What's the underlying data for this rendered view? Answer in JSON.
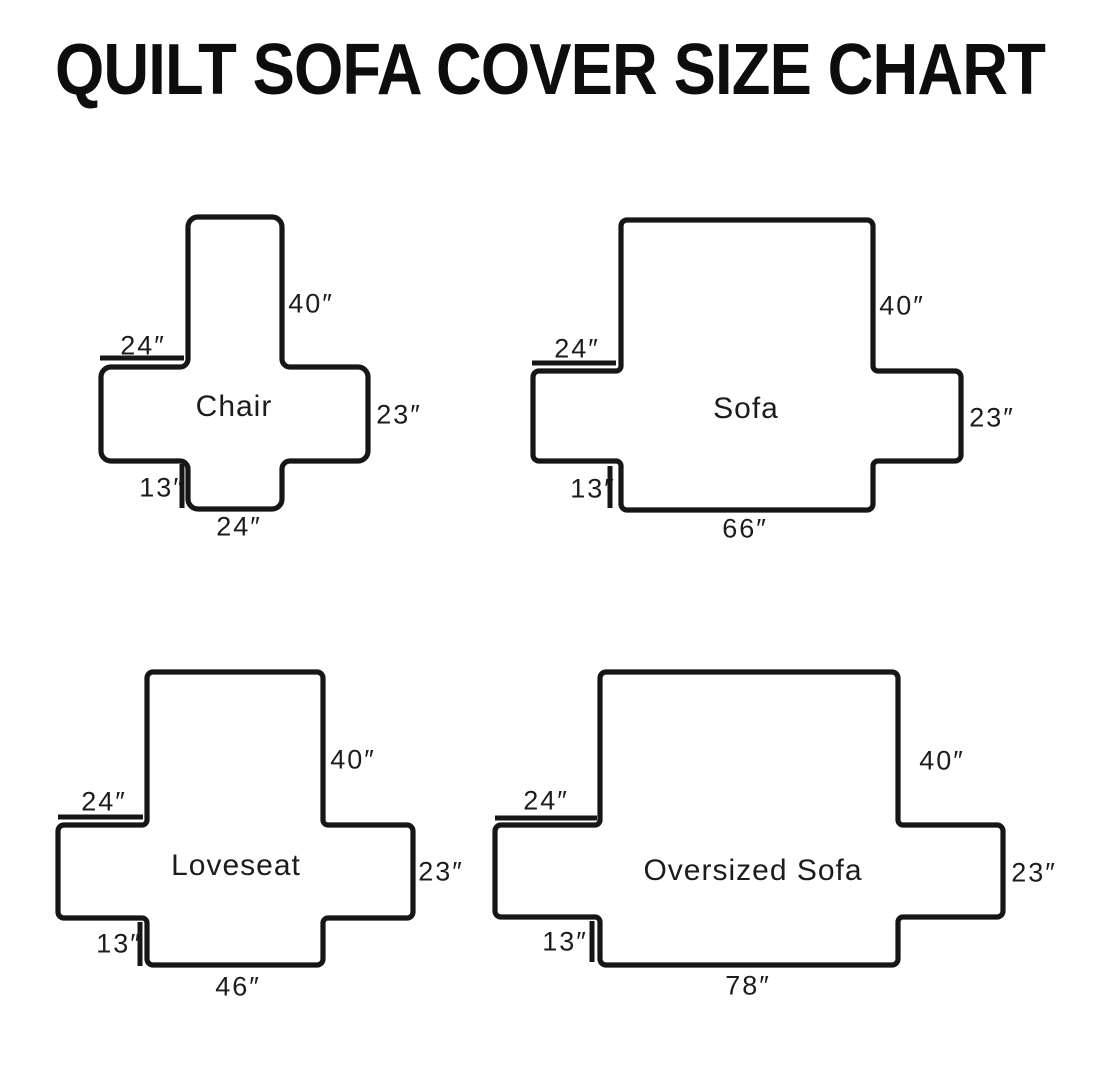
{
  "title": "QUILT SOFA COVER SIZE CHART",
  "colors": {
    "background": "#ffffff",
    "line": "#161616",
    "text": "#1c1c1c"
  },
  "diagrams": [
    {
      "name": "Chair",
      "back_height": "40″",
      "arm_top_width": "24″",
      "side_height": "23″",
      "skirt_drop": "13″",
      "base_width": "24″"
    },
    {
      "name": "Sofa",
      "back_height": "40″",
      "arm_top_width": "24″",
      "side_height": "23″",
      "skirt_drop": "13″",
      "base_width": "66″"
    },
    {
      "name": "Loveseat",
      "back_height": "40″",
      "arm_top_width": "24″",
      "side_height": "23″",
      "skirt_drop": "13″",
      "base_width": "46″"
    },
    {
      "name": "Oversized Sofa",
      "back_height": "40″",
      "arm_top_width": "24″",
      "side_height": "23″",
      "skirt_drop": "13″",
      "base_width": "78″"
    }
  ]
}
